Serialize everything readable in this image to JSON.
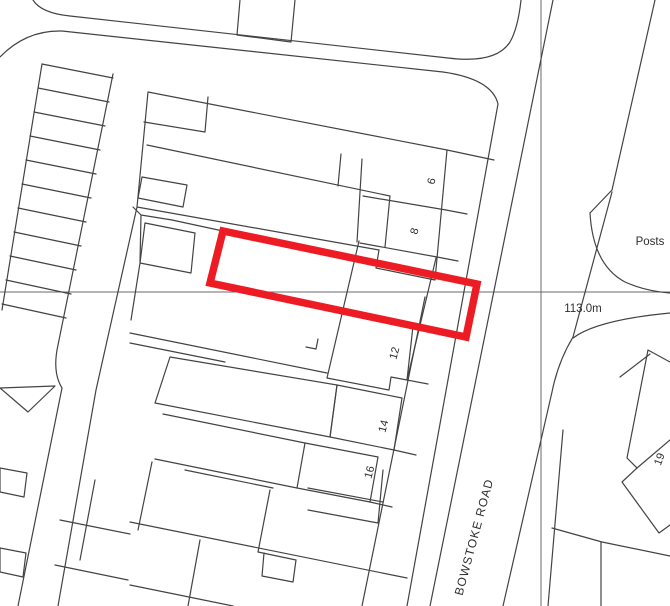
{
  "labels": {
    "road_name": "BOWSTOKE ROAD",
    "spot_height": "113.0m",
    "posts": "Posts",
    "house_6": "6",
    "house_8": "8",
    "house_12": "12",
    "house_14": "14",
    "house_16": "16",
    "house_19": "19"
  },
  "colors": {
    "plot_outline": "#ed1c24",
    "map_line": "#434343",
    "grid_line": "#6a6a6a",
    "label_text": "#2e2e2e",
    "background": "#ffffff"
  }
}
